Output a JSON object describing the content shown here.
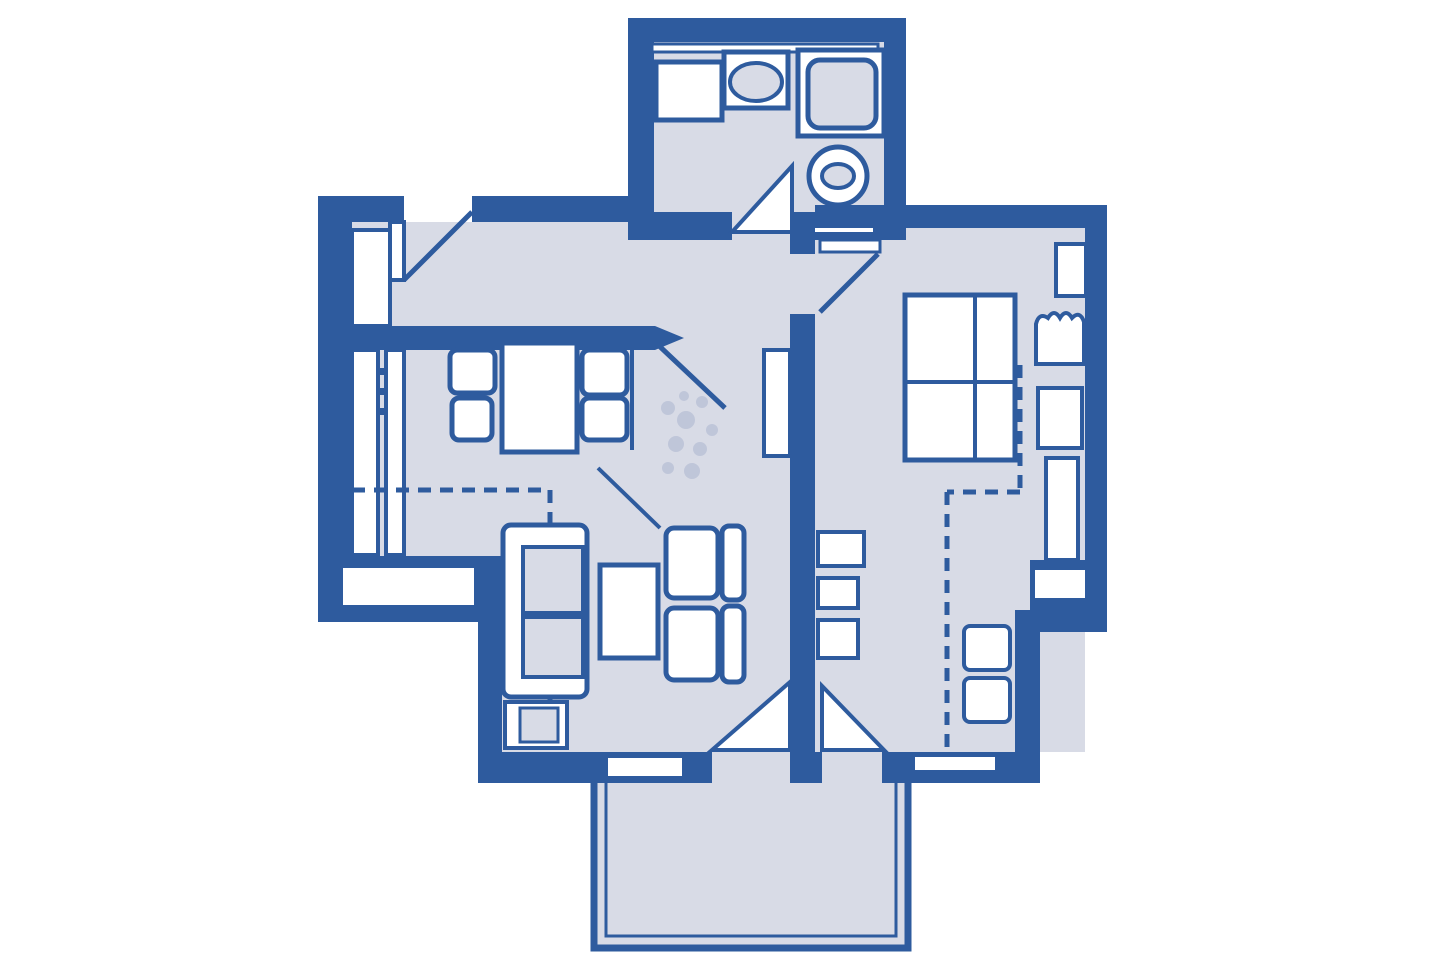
{
  "document": {
    "kind": "apartment-floor-plan"
  },
  "colors": {
    "wall": "#2e5b9e",
    "edge": "#1c3c6e",
    "floor": "#d8dbe6",
    "background": "#ffffff",
    "fixture": "#ffffff",
    "speckle": "#b9c0d6"
  },
  "rooms": [
    {
      "name": "bathroom",
      "fixtures": [
        "mirror-shelf",
        "vanity",
        "toilet",
        "shower",
        "washbasin",
        "door-swing"
      ]
    },
    {
      "name": "hallway",
      "fixtures": [
        "entrance-door",
        "closet",
        "door-swing-to-living"
      ]
    },
    {
      "name": "kitchen-dining",
      "fixtures": [
        "kitchen-counter",
        "dining-table",
        "chair-top-left",
        "chair-bottom-left",
        "chair-top-right",
        "chair-bottom-right",
        "window",
        "roof-slope-line",
        "partition-line"
      ]
    },
    {
      "name": "living-room",
      "fixtures": [
        "sofa",
        "ottoman",
        "coffee-table",
        "armchair-upper",
        "armchair-lower",
        "plant",
        "wall-shelf",
        "balcony-door-swing",
        "window"
      ]
    },
    {
      "name": "bedroom",
      "fixtures": [
        "entry-door",
        "double-bed",
        "nightstand-upper",
        "bedside-chair",
        "nightstand-lower",
        "wardrobe",
        "chest-of-drawers",
        "stool-upper",
        "stool-lower",
        "wall-niche-shelf",
        "closet-outline",
        "balcony-door-swing",
        "window"
      ]
    },
    {
      "name": "balcony",
      "fixtures": [
        "railing"
      ]
    }
  ]
}
